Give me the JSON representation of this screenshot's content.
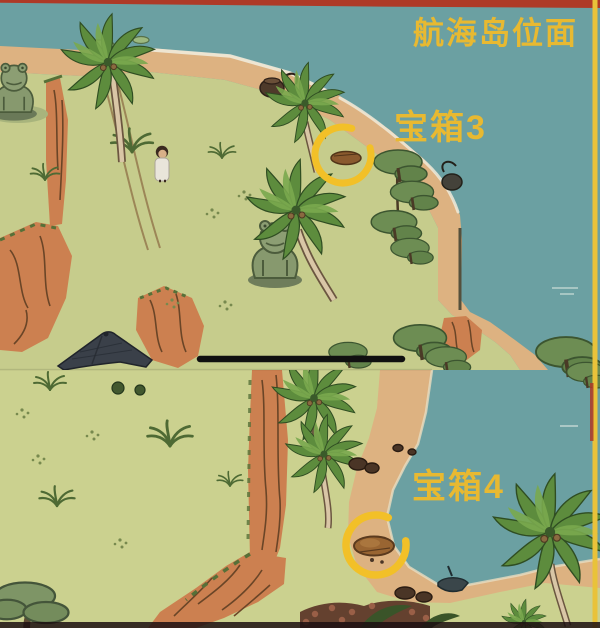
{
  "page": {
    "title": "航海岛位面"
  },
  "panels": [
    {
      "id": "top-capture",
      "marker_label": "宝箱3"
    },
    {
      "id": "bottom-capture",
      "marker_label": "宝箱4"
    }
  ],
  "colors": {
    "water": "#6ba0a2",
    "grass_top": "#c6cc8c",
    "grass_bottom": "#cbd18f",
    "sand": "#ddb281",
    "foam": "#f0ead9",
    "cliff": "#cc8050",
    "cliff_shadow": "#6a4527",
    "palm_green": "#5d8c3d",
    "statue_green": "#87996e",
    "roof_slate": "#3a4049",
    "label_gold": "#e8b931",
    "marker_yellow": "#f2c028",
    "border_red": "#ae3a27",
    "border_yellow": "#e9c23a",
    "divider_black": "#101010"
  }
}
